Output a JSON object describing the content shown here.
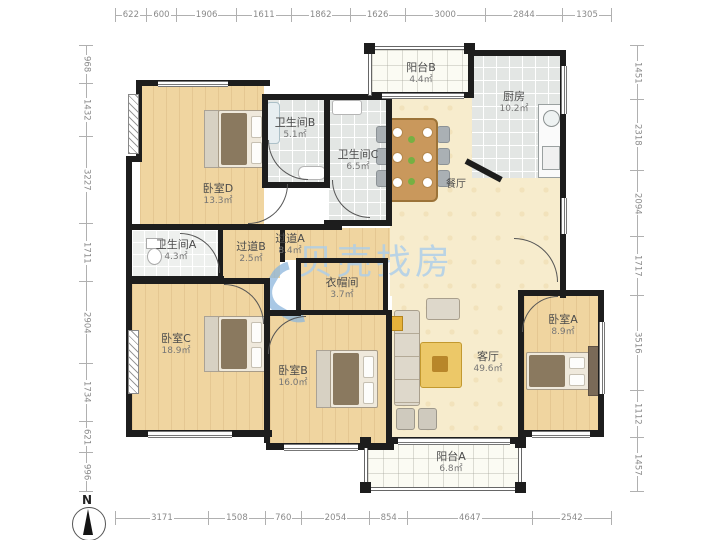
{
  "watermark": {
    "text": "贝壳找房"
  },
  "compass": {
    "label": "N"
  },
  "colors": {
    "wall": "#1d1d1d",
    "wood_floor": "#f0d5a0",
    "living_floor": "#f7eccd",
    "tile_floor": "#e3e6e4",
    "watermark_blue": "#abcdea"
  },
  "dimensions": {
    "top": [
      "622",
      "600",
      "1906",
      "1611",
      "1862",
      "1626",
      "3000",
      "2844",
      "1305"
    ],
    "bottom": [
      "3171",
      "1508",
      "760",
      "2054",
      "854",
      "4647",
      "2542"
    ],
    "left": [
      "968",
      "1432",
      "3227",
      "1711",
      "2904",
      "1734",
      "621",
      "996"
    ],
    "right": [
      "1451",
      "2318",
      "2094",
      "1717",
      "3516",
      "1112",
      "1457"
    ]
  },
  "rooms": [
    {
      "name": "阳台B",
      "area": "4.4㎡"
    },
    {
      "name": "厨房",
      "area": "10.2㎡"
    },
    {
      "name": "卫生间B",
      "area": "5.1㎡"
    },
    {
      "name": "卫生间C",
      "area": "6.5㎡"
    },
    {
      "name": "卧室D",
      "area": "13.3㎡"
    },
    {
      "name": "餐厅",
      "area": ""
    },
    {
      "name": "卫生间A",
      "area": "4.3㎡"
    },
    {
      "name": "过道B",
      "area": "2.5㎡"
    },
    {
      "name": "过道A",
      "area": "8.4㎡"
    },
    {
      "name": "衣帽间",
      "area": "3.7㎡"
    },
    {
      "name": "卧室C",
      "area": "18.9㎡"
    },
    {
      "name": "卧室B",
      "area": "16.0㎡"
    },
    {
      "name": "客厅",
      "area": "49.6㎡"
    },
    {
      "name": "卧室A",
      "area": "8.9㎡"
    },
    {
      "name": "阳台A",
      "area": "6.8㎡"
    }
  ]
}
